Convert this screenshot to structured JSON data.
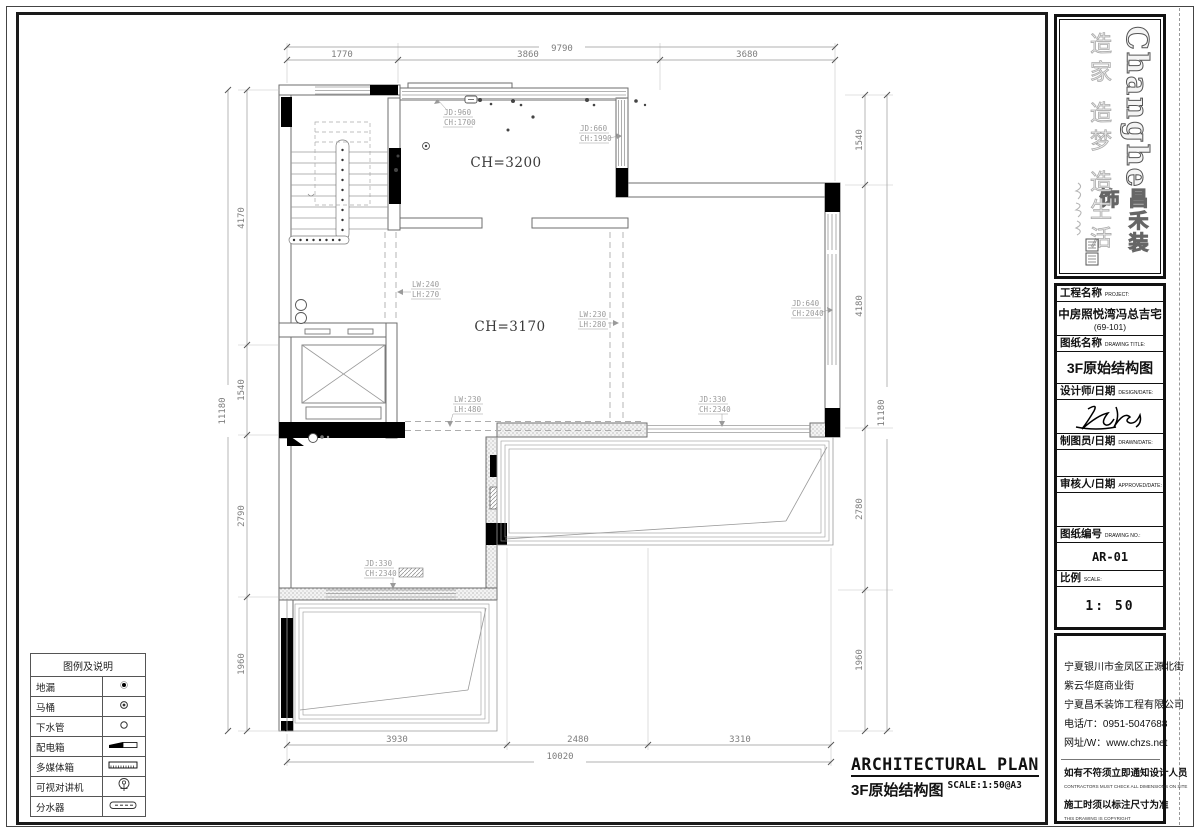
{
  "brand": {
    "latin": "Changhe",
    "cjk": "昌禾装饰",
    "slogan": "造家 造梦 造生活"
  },
  "titleblock": {
    "project_label": "工程名称",
    "project_sub": "PROJECT:",
    "project_value": "中房照悦湾冯总吉宅",
    "project_value2": "(69-101)",
    "drawing_label": "图纸名称",
    "drawing_sub": "DRAWING TITLE:",
    "drawing_value": "3F原始结构图",
    "designer_label": "设计师/日期",
    "designer_sub": "DESIGN/DATE:",
    "draftsman_label": "制图员/日期",
    "draftsman_sub": "DRAWN/DATE:",
    "approver_label": "审核人/日期",
    "approver_sub": "APPROVED/DATE:",
    "number_label": "图纸编号",
    "number_sub": "DRAWING NO.:",
    "number_value": "AR-01",
    "scale_label": "比例",
    "scale_sub": "SCALE:",
    "scale_value": "1: 50"
  },
  "address": {
    "line1": "宁夏银川市金凤区正源北街",
    "line2": "紫云华庭商业街",
    "line3": "宁夏昌禾装饰工程有限公司",
    "phone": "电话/T：0951-5047688",
    "web": "网址/W：www.chzs.net",
    "notice1": "如有不符须立即通知设计人员",
    "notice1_sub": "CONTRACTORS MUST CHECK ALL DIMENSIONS ON SITE",
    "notice2": "施工时须以标注尺寸为准",
    "notice2_sub": "THIS DRAWING IS COPYRIGHT"
  },
  "footer": {
    "title_en": "ARCHITECTURAL PLAN",
    "title_cn": "3F原始结构图",
    "scale_note": "SCALE:1:50@A3"
  },
  "legend": {
    "title": "图例及说明",
    "items": [
      {
        "label": "地漏"
      },
      {
        "label": "马桶"
      },
      {
        "label": "下水管"
      },
      {
        "label": "配电箱"
      },
      {
        "label": "多媒体箱"
      },
      {
        "label": "可视对讲机"
      },
      {
        "label": "分水器"
      }
    ]
  },
  "rooms": {
    "top": "CH=3200",
    "main": "CH=3170"
  },
  "dims": {
    "top": {
      "total": "9790",
      "s1": "1770",
      "s2": "3860",
      "s3": "3680"
    },
    "bottom": {
      "total": "10020",
      "s1": "3930",
      "s2": "2480",
      "s3": "3310"
    },
    "left": {
      "total": "11180",
      "s1": "4170",
      "s2": "1540",
      "s3": "2790",
      "s4": "1960"
    },
    "right": {
      "total": "11180",
      "s1": "1540",
      "s2": "4180",
      "s3": "2780",
      "s4": "1960"
    }
  },
  "annotations": {
    "jd960": {
      "l1": "JD:960",
      "l2": "CH:1700"
    },
    "jd660": {
      "l1": "JD:660",
      "l2": "CH:1990"
    },
    "jd640": {
      "l1": "JD:640",
      "l2": "CH:2040"
    },
    "lw240": {
      "l1": "LW:240",
      "l2": "LH:270"
    },
    "lw230a": {
      "l1": "LW:230",
      "l2": "LH:280"
    },
    "lw230b": {
      "l1": "LW:230",
      "l2": "LH:480"
    },
    "jd330a": {
      "l1": "JD:330",
      "l2": "CH:2340"
    },
    "jd330b": {
      "l1": "JD:330",
      "l2": "CH:2340"
    }
  }
}
